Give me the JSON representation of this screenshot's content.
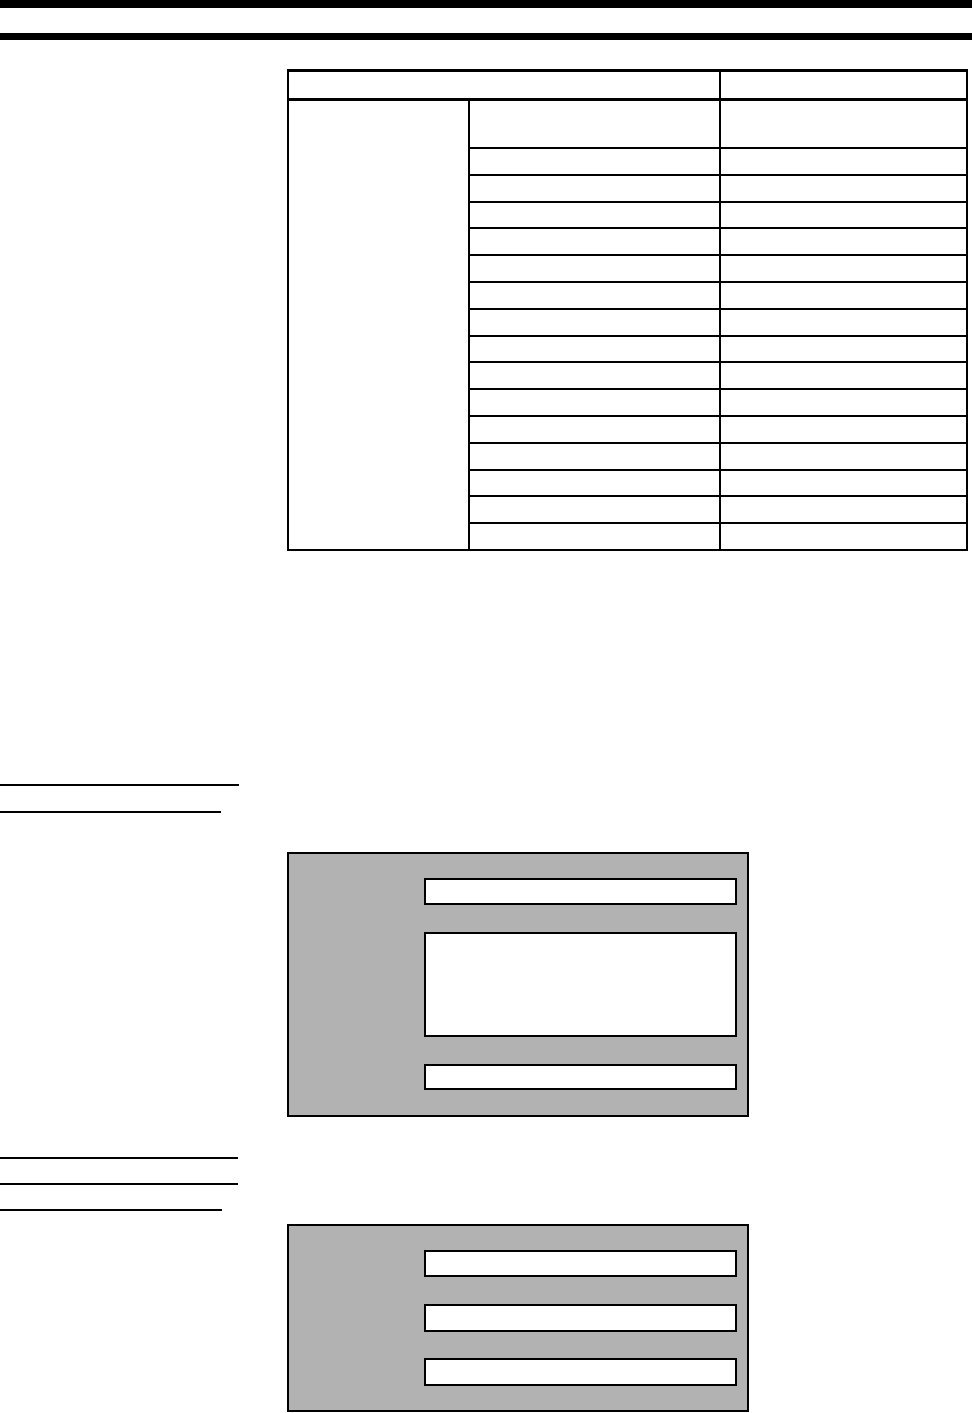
{
  "page": {
    "background_color": "#ffffff",
    "ink_color": "#000000",
    "header": {
      "top_bar_color": "#000000",
      "title_rule_color": "#000000",
      "title_text": ""
    },
    "spec_table": {
      "border_color": "#000000",
      "header": {
        "left_cell": "",
        "right_cell": ""
      },
      "category_cell": "",
      "row_count": 16,
      "rows": [
        {
          "label": "",
          "value": ""
        },
        {
          "label": "",
          "value": ""
        },
        {
          "label": "",
          "value": ""
        },
        {
          "label": "",
          "value": ""
        },
        {
          "label": "",
          "value": ""
        },
        {
          "label": "",
          "value": ""
        },
        {
          "label": "",
          "value": ""
        },
        {
          "label": "",
          "value": ""
        },
        {
          "label": "",
          "value": ""
        },
        {
          "label": "",
          "value": ""
        },
        {
          "label": "",
          "value": ""
        },
        {
          "label": "",
          "value": ""
        },
        {
          "label": "",
          "value": ""
        },
        {
          "label": "",
          "value": ""
        },
        {
          "label": "",
          "value": ""
        },
        {
          "label": "",
          "value": ""
        }
      ]
    },
    "margin_rules": {
      "group_top_count": 2,
      "group_bottom_count": 3,
      "color": "#000000"
    },
    "screen_mockups": [
      {
        "background_color": "#b2b2b2",
        "border_color": "#000000",
        "fields": [
          {
            "text": ""
          },
          {
            "text": ""
          },
          {
            "text": ""
          }
        ]
      },
      {
        "background_color": "#b2b2b2",
        "border_color": "#000000",
        "fields": [
          {
            "text": ""
          },
          {
            "text": ""
          },
          {
            "text": ""
          }
        ]
      }
    ]
  }
}
